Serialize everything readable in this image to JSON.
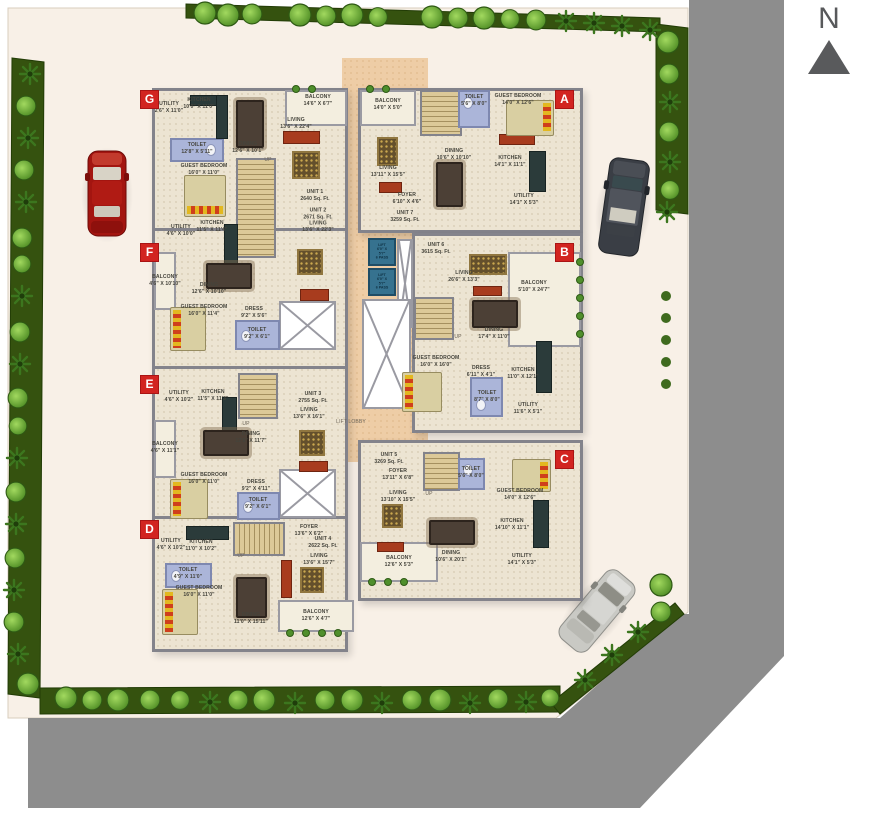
{
  "plan": {
    "north_label": "N",
    "lift_label": "LIFT\n6'0\" X 5'7\"\n6 PASS",
    "lobby_label": "LIFT LOBBY",
    "up_label": "UP",
    "units": {
      "a": {
        "badge": "A",
        "balcony": "BALCONY\n14'0\" X 5'0\"",
        "toilet": "TOILET\n5'6\" X 8'0\"",
        "guest": "GUEST BEDROOM\n14'0\" X 12'6\"",
        "dining": "DINING\n10'6\" X 10'10\"",
        "living": "LIVING\n13'11\" X 15'5\"",
        "kitchen": "KITCHEN\n14'1\" X 11'1\"",
        "foyer": "FOYER\n6'10\" X 4'6\"",
        "unit": "UNIT 7\n3259 Sq. Ft.",
        "utility": "UTILITY\n14'1\" X 5'3\""
      },
      "b": {
        "badge": "B",
        "unit": "UNIT 6\n3615 Sq. Ft.",
        "living": "LIVING\n26'6\" X 13'3\"",
        "balcony": "BALCONY\n5'10\" X 24'7\"",
        "dining": "DINING\n17'4\" X 11'0\"",
        "guest": "GUEST BEDROOM\n16'0\" X 16'0\"",
        "dress": "DRESS\n6'11\" X 4'1\"",
        "toilet": "TOILET\n8'7\" X 8'0\"",
        "kitchen": "KITCHEN\n11'0\" X 12'1\"",
        "utility": "UTILITY\n11'6\" X 5'1\""
      },
      "c": {
        "badge": "C",
        "unit": "UNIT 5\n3269 Sq. Ft.",
        "foyer": "FOYER\n13'11\" X 6'8\"",
        "toilet": "TOILET\n5'6\" X 8'0\"",
        "living": "LIVING\n13'10\" X 15'5\"",
        "guest": "GUEST BEDROOM\n14'0\" X 12'6\"",
        "kitchen": "KITCHEN\n14'10\" X 11'1\"",
        "dining": "DINING\n10'6\" X 20'1\"",
        "utility": "UTILITY\n14'1\" X 5'3\"",
        "balcony": "BALCONY\n12'6\" X 5'3\""
      },
      "d": {
        "badge": "D",
        "kitchen": "KITCHEN\n11'0\" X 10'2\"",
        "utility": "UTILITY\n4'6\" X 10'2\"",
        "foyer": "FOYER\n13'6\" X 6'2\"",
        "unit": "UNIT 4\n2622 Sq. Ft.",
        "living": "LIVING\n13'6\" X 15'7\"",
        "toilet": "TOILET\n4'9\" X 11'0\"",
        "guest": "GUEST BEDROOM\n16'0\" X 11'0\"",
        "dining": "DINING\n11'0\" X 15'11\"",
        "balcony": "BALCONY\n12'6\" X 4'7\""
      },
      "e": {
        "badge": "E",
        "utility": "UTILITY\n4'6\" X 10'2\"",
        "kitchen": "KITCHEN\n11'5\" X 11'3\"",
        "unit": "UNIT 3\n2755 Sq. Ft.",
        "living": "LIVING\n13'6\" X 16'1\"",
        "dining": "DINING\n12'6\" X 11'7\"",
        "balcony": "BALCONY\n4'6\" X 11'1\"",
        "guest": "GUEST BEDROOM\n16'0\" X 11'0\"",
        "dress": "DRESS\n9'2\" X 4'11\"",
        "toilet": "TOILET\n9'2\" X 6'1\""
      },
      "f": {
        "badge": "F",
        "utility": "UTILITY\n4'6\" X 10'0\"",
        "kitchen": "KITCHEN\n11'5\" X 11'4\"",
        "unit": "UNIT 2\n2671 Sq. Ft.\nLIVING\n13'6\" X 22'3\"",
        "balcony": "BALCONY\n4'6\" X 10'10\"",
        "dining": "DINING\n12'6\" X 10'10\"",
        "guest": "GUEST BEDROOM\n16'0\" X 11'4\"",
        "dress": "DRESS\n9'2\" X 5'6\"",
        "toilet": "TOILET\n9'2\" X 6'1\""
      },
      "g": {
        "badge": "G",
        "utility": "UTILITY\n2'6\" X 11'0\"",
        "kitchen": "KITCHEN\n10'0\" X 11'0\"",
        "balcony": "BALCONY\n14'6\" X 6'7\"",
        "living": "LIVING\n13'6\" X 22'4\"",
        "dining": "DINING\n12'6\" X 10'1\"",
        "toilet": "TOILET\n12'8\" X 5'11\"",
        "guest": "GUEST BEDROOM\n16'0\" X 11'0\"",
        "unit": "UNIT 1\n2640 Sq. Ft."
      }
    },
    "colors": {
      "accent_red": "#d22420",
      "lift_blue": "#36728f",
      "toilet_blue": "#abb5d9",
      "road_gray": "#8d8d8d",
      "site_cream": "#f8f0e7",
      "lobby_peach": "#eecda6"
    }
  }
}
